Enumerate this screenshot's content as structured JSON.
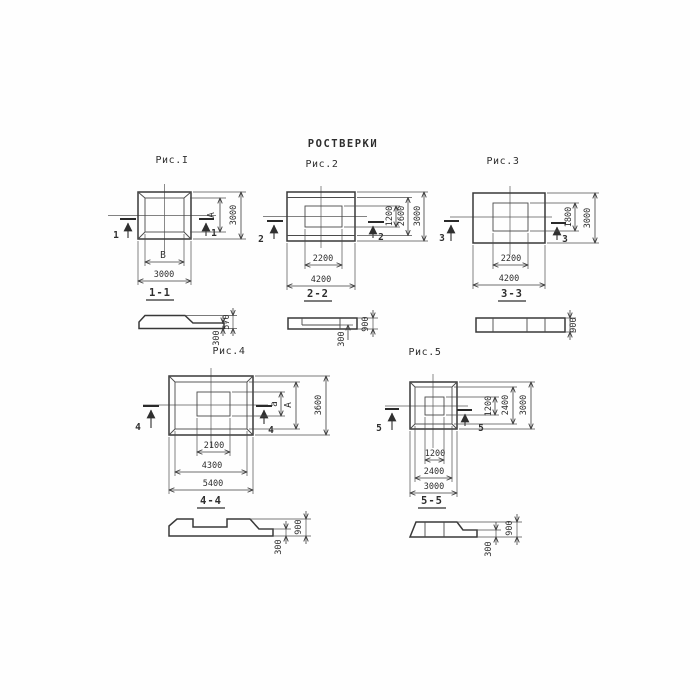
{
  "title": "РОСТВЕРКИ",
  "ink_color": "#3b3b3b",
  "paper_color": "#ffffff",
  "fig1": {
    "caption": "Рис.I",
    "cut": "1",
    "section_label": "1-1",
    "dim_inner_width": "В",
    "dim_outer_width": "3000",
    "dim_inner_height": "А",
    "dim_outer_height": "3000",
    "sec_total_height": "570",
    "sec_edge_height": "300"
  },
  "fig2": {
    "caption": "Рис.2",
    "cut": "2",
    "section_label": "2-2",
    "dim_inner_width": "2200",
    "dim_outer_width": "4200",
    "dim_h1": "1200",
    "dim_h2": "2600",
    "dim_h3": "3000",
    "sec_total_height": "900",
    "sec_edge_height": "300"
  },
  "fig3": {
    "caption": "Рис.3",
    "cut": "3",
    "section_label": "3-3",
    "dim_inner_width": "2200",
    "dim_outer_width": "4200",
    "dim_inner_height": "1800",
    "dim_outer_height": "3000",
    "sec_total_height": "900"
  },
  "fig4": {
    "caption": "Рис.4",
    "cut": "4",
    "section_label": "4-4",
    "dim_w1": "2100",
    "dim_w2": "4300",
    "dim_w3": "5400",
    "dim_h1": "а",
    "dim_h2": "А",
    "dim_h3": "3600",
    "sec_total_height": "900",
    "sec_edge_height": "300"
  },
  "fig5": {
    "caption": "Рис.5",
    "cut": "5",
    "section_label": "5-5",
    "dim_w1": "1200",
    "dim_w2": "2400",
    "dim_w3": "3000",
    "dim_h1": "1200",
    "dim_h2": "2400",
    "dim_h3": "3000",
    "sec_total_height": "900",
    "sec_edge_height": "300"
  }
}
